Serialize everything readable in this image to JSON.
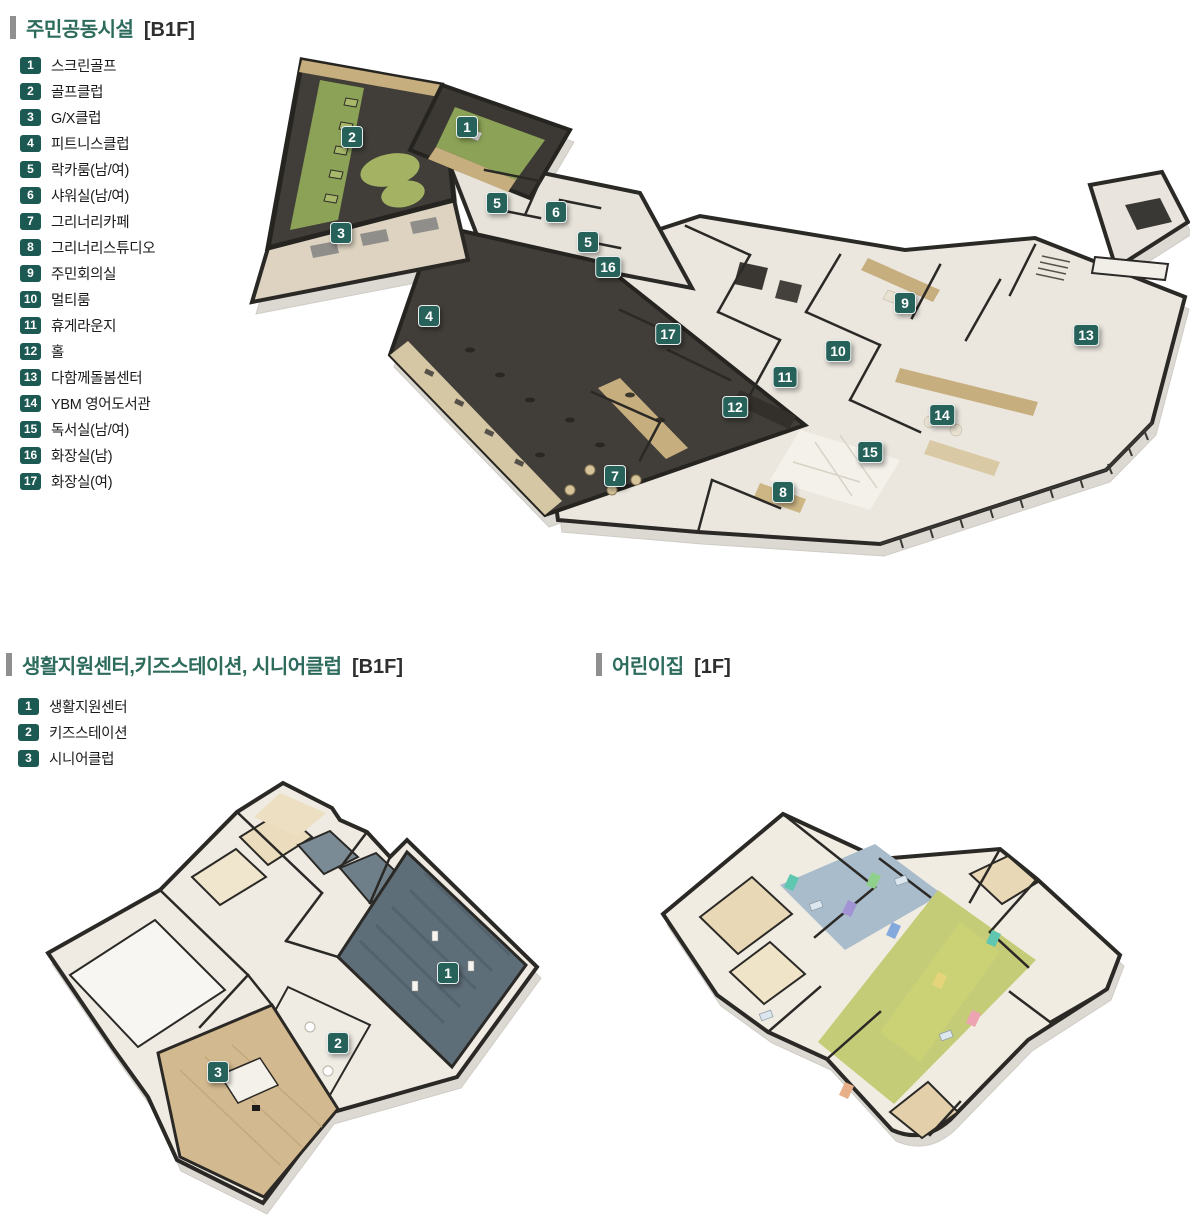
{
  "colors": {
    "accent_title": "#2d6b5c",
    "badge_bg": "#1d5953",
    "plan_badge_bg": "#26615a",
    "wall_dark": "#2b2926",
    "floor_light": "#ebe7df",
    "turf_green": "#8ca257",
    "carpet_dark": "#413e39",
    "wood": "#c7ae7e",
    "teal_carpet": "#5e6e79",
    "daycare_corridor": "#c5cc77",
    "plinth": "#dcd9d3"
  },
  "sections": [
    {
      "id": "community",
      "title": "주민공동시설",
      "floor": "[B1F]",
      "legend": [
        {
          "num": "1",
          "label": "스크린골프"
        },
        {
          "num": "2",
          "label": "골프클럽"
        },
        {
          "num": "3",
          "label": "G/X클럽"
        },
        {
          "num": "4",
          "label": "피트니스클럽"
        },
        {
          "num": "5",
          "label": "락카룸(남/여)"
        },
        {
          "num": "6",
          "label": "샤워실(남/여)"
        },
        {
          "num": "7",
          "label": "그리너리카페"
        },
        {
          "num": "8",
          "label": "그리너리스튜디오"
        },
        {
          "num": "9",
          "label": "주민회의실"
        },
        {
          "num": "10",
          "label": "멀티룸"
        },
        {
          "num": "11",
          "label": "휴게라운지"
        },
        {
          "num": "12",
          "label": "홀"
        },
        {
          "num": "13",
          "label": "다함께돌봄센터"
        },
        {
          "num": "14",
          "label": "YBM 영어도서관"
        },
        {
          "num": "15",
          "label": "독서실(남/여)"
        },
        {
          "num": "16",
          "label": "화장실(남)"
        },
        {
          "num": "17",
          "label": "화장실(여)"
        }
      ],
      "plan_badges": [
        {
          "num": "1",
          "x": 227,
          "y": 77
        },
        {
          "num": "2",
          "x": 112,
          "y": 87
        },
        {
          "num": "3",
          "x": 101,
          "y": 183
        },
        {
          "num": "4",
          "x": 189,
          "y": 266
        },
        {
          "num": "5",
          "x": 257,
          "y": 153
        },
        {
          "num": "6",
          "x": 316,
          "y": 162
        },
        {
          "num": "5",
          "x": 348,
          "y": 192
        },
        {
          "num": "16",
          "x": 368,
          "y": 217
        },
        {
          "num": "17",
          "x": 428,
          "y": 284
        },
        {
          "num": "9",
          "x": 665,
          "y": 253
        },
        {
          "num": "10",
          "x": 598,
          "y": 301
        },
        {
          "num": "11",
          "x": 545,
          "y": 327
        },
        {
          "num": "12",
          "x": 495,
          "y": 357
        },
        {
          "num": "13",
          "x": 846,
          "y": 285
        },
        {
          "num": "14",
          "x": 702,
          "y": 365
        },
        {
          "num": "15",
          "x": 630,
          "y": 402
        },
        {
          "num": "8",
          "x": 543,
          "y": 442
        },
        {
          "num": "7",
          "x": 375,
          "y": 426
        }
      ]
    },
    {
      "id": "support",
      "title": "생활지원센터,키즈스테이션, 시니어클럽",
      "floor": "[B1F]",
      "legend": [
        {
          "num": "1",
          "label": "생활지원센터"
        },
        {
          "num": "2",
          "label": "키즈스테이션"
        },
        {
          "num": "3",
          "label": "시니어클럽"
        }
      ],
      "plan_badges": [
        {
          "num": "1",
          "x": 408,
          "y": 198
        },
        {
          "num": "2",
          "x": 298,
          "y": 268
        },
        {
          "num": "3",
          "x": 178,
          "y": 297
        }
      ]
    },
    {
      "id": "daycare",
      "title": "어린이집",
      "floor": "[1F]",
      "legend": [],
      "plan_badges": []
    }
  ]
}
